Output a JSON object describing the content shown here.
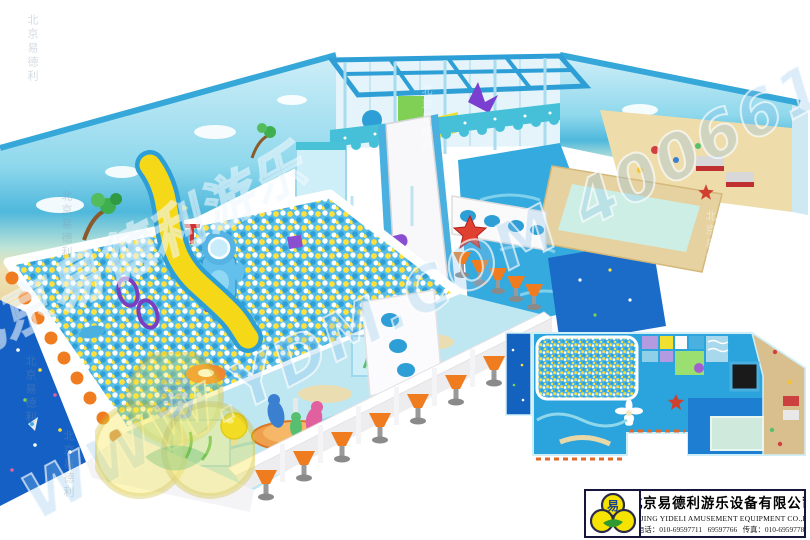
{
  "watermarks": {
    "diagonal_text": "WWW.YDM.COM 4006610168",
    "diagonal_text_cn": "北京易德利游乐",
    "vertical_text": "北京易德利",
    "logo_character": "易"
  },
  "company_panel": {
    "logo_character": "易",
    "company_name_cn": "北京易德利游乐设备有限公司",
    "company_name_en": "BEIJING YIDELI AMUSEMENT EQUIPMENT CO.,LTD",
    "contact_line": "电话：010-69597711   69597766   传真：010-69597788"
  },
  "colors": {
    "page_background": "#ffffff",
    "pool_floor_blue": "#2ba3dc",
    "deep_mat_blue": "#1565c8",
    "ball_yellow": "#ffe03c",
    "ball_blue": "#2f9fd8",
    "sand_tan": "#ecd9a8",
    "stool_orange": "#ef7d20",
    "awning_teal": "#45c0d8",
    "starfish_red": "#d93b2b",
    "logo_yellow": "#f6e400",
    "logo_green": "#2f9a2f"
  }
}
